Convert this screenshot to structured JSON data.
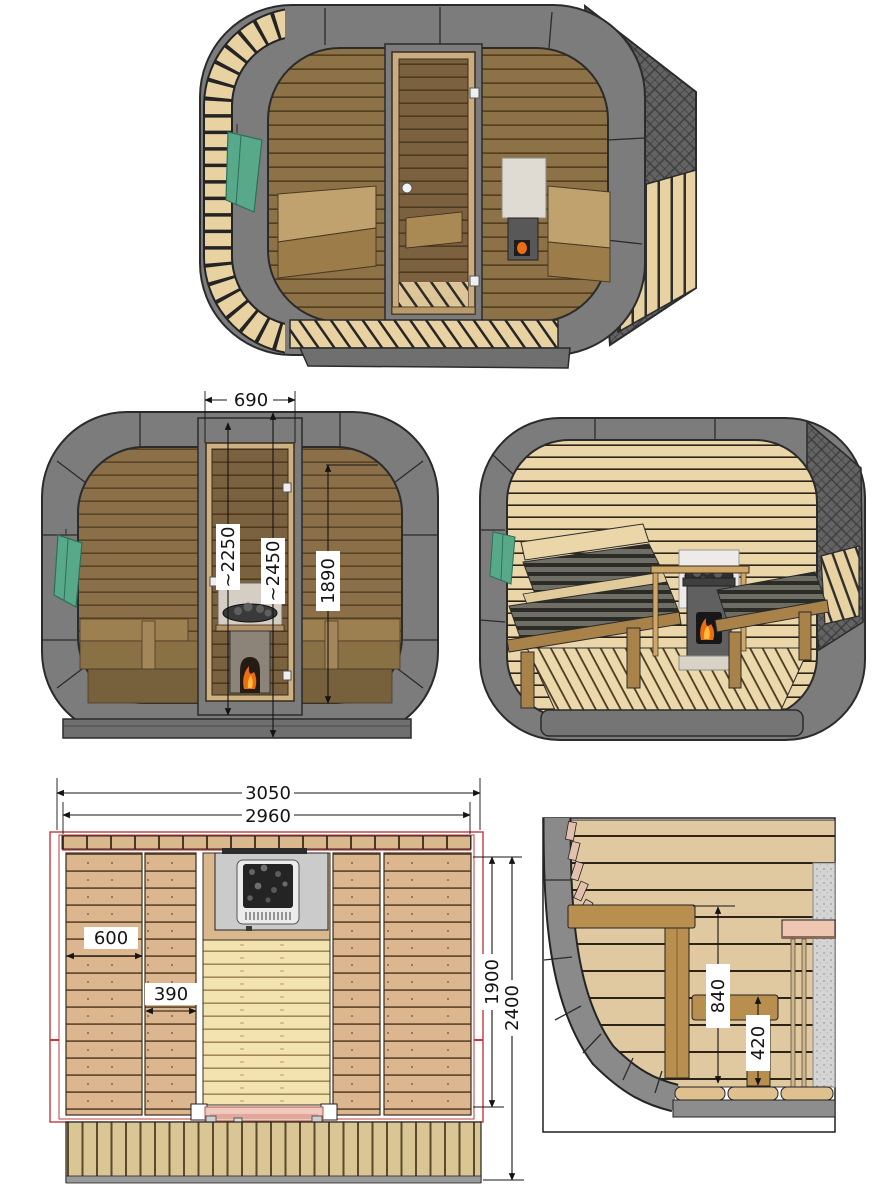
{
  "colors": {
    "background": "#ffffff",
    "frame_gray": "#7c7c7c",
    "outline_dark": "#2b2b2b",
    "tinted_glass_wood": "#8a6f48",
    "interior_wood_light": "#ead6a8",
    "bench_wood_brown": "#a9824a",
    "bench_wood_tan": "#c2a269",
    "shingle_gray": "#636363",
    "slat_cream": "#e8d2a2",
    "plan_bench_wood": "#dcb68e",
    "plan_floor_wood": "#f3e3b1",
    "terrace_wood": "#d9c694",
    "roof_outline_red": "#c23b3b",
    "door_leaf_pink": "#f0c8bd",
    "towel_green": "#57a98a",
    "fire_orange": "#ef6d12",
    "stove_gray": "#606060",
    "dimension_ink": "#141414",
    "label_background": "#ffffff"
  },
  "views": {
    "front": {
      "dimensions": {
        "door_width": "690",
        "door_height": "~2250",
        "overall_inner_height": "~2450",
        "glazing_height": "1890"
      }
    },
    "plan": {
      "dimensions": {
        "overall_width": "3050",
        "body_width": "2960",
        "wide_bench_depth": "600",
        "narrow_bench_depth": "390",
        "room_depth": "1900",
        "overall_depth": "2400"
      }
    },
    "section": {
      "dimensions": {
        "upper_bench_height": "840",
        "lower_bench_height": "420"
      }
    }
  }
}
